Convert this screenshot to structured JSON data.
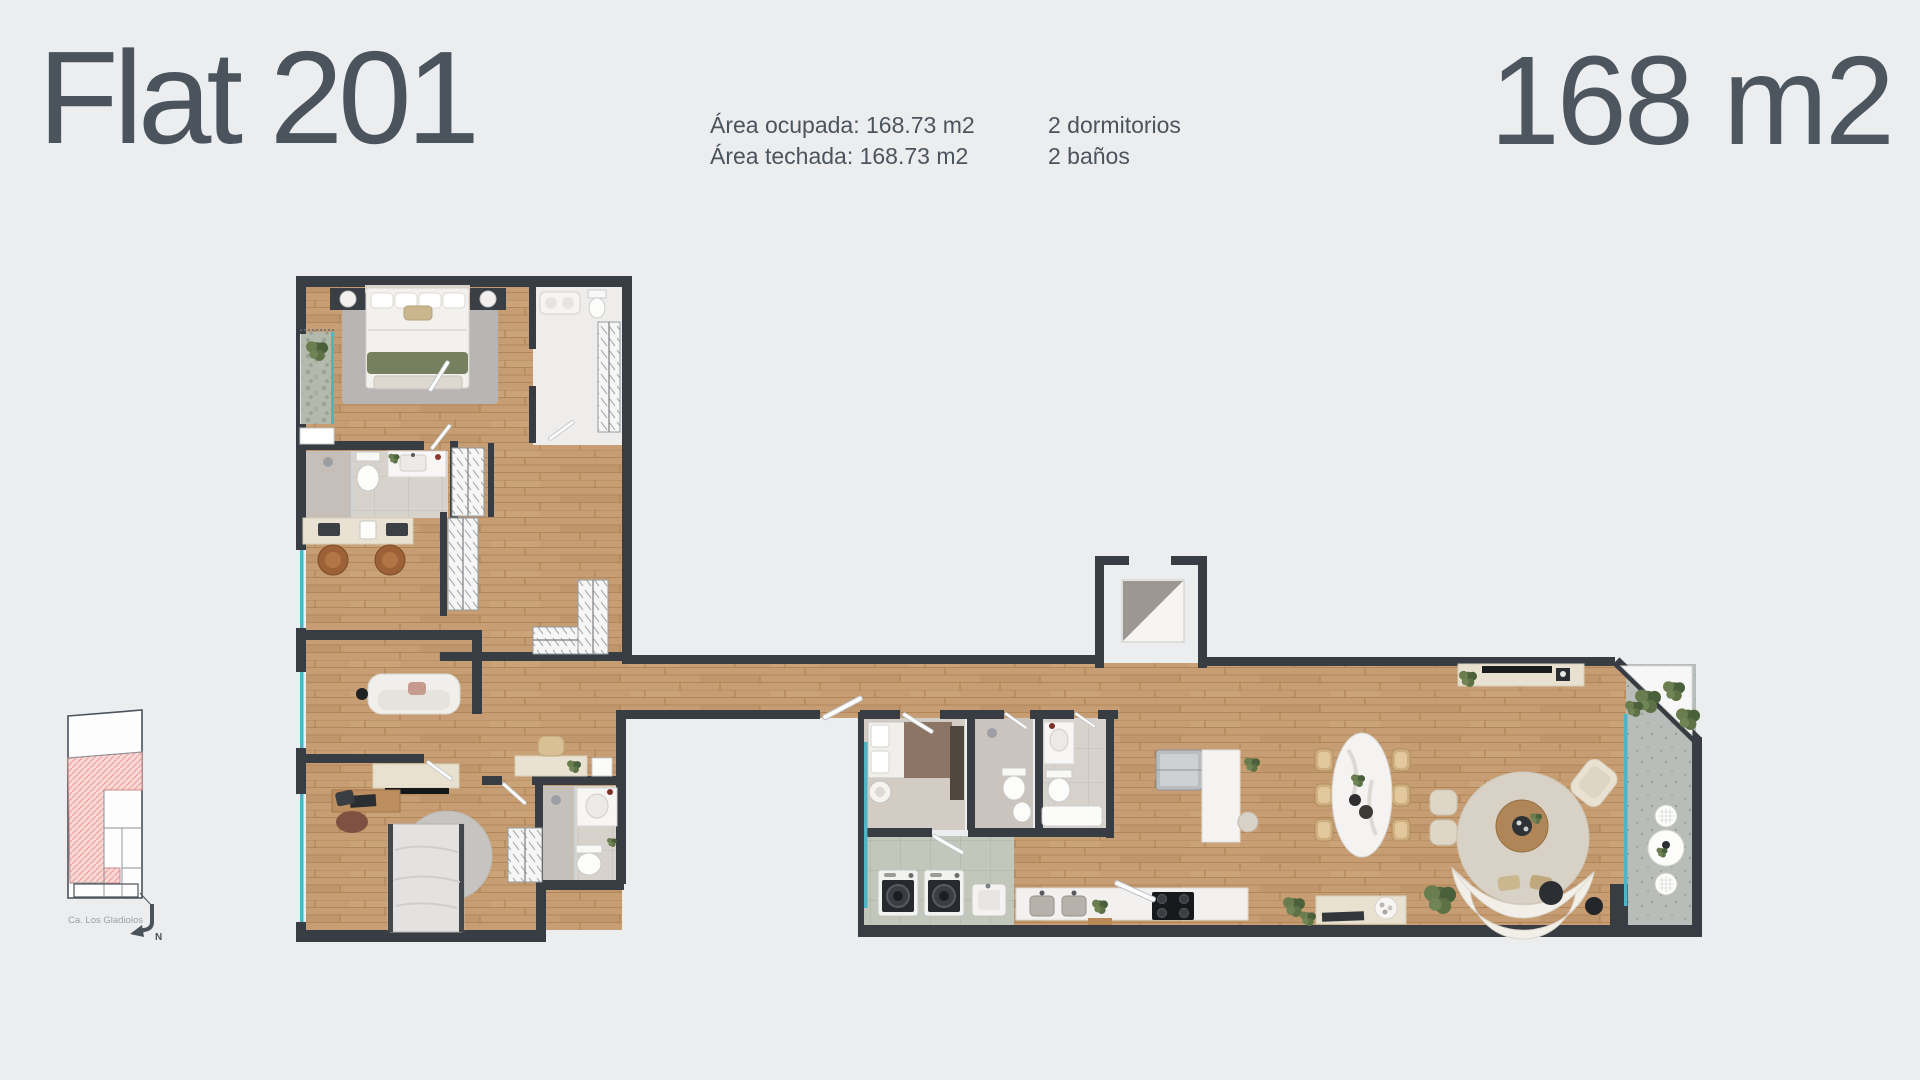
{
  "header": {
    "title": "Flat 201",
    "area_occupied": "Área ocupada: 168.73 m2",
    "area_roofed": "Área techada: 168.73 m2",
    "bedrooms": "2 dormitorios",
    "bathrooms": "2 baños",
    "total_area": "168 m2"
  },
  "key_plan": {
    "street_label": "Ca. Los Gladiolos",
    "north_label": "N"
  },
  "colors": {
    "background": "#ecedef",
    "text": "#4b545d",
    "wall": "#383d43",
    "wood_floor": "#c79e74",
    "glass": "#4db5c6",
    "unit_highlight_pink": "#f9d8d6",
    "rug_gray": "#b8b6b4",
    "plant_green": "#5d7245"
  }
}
